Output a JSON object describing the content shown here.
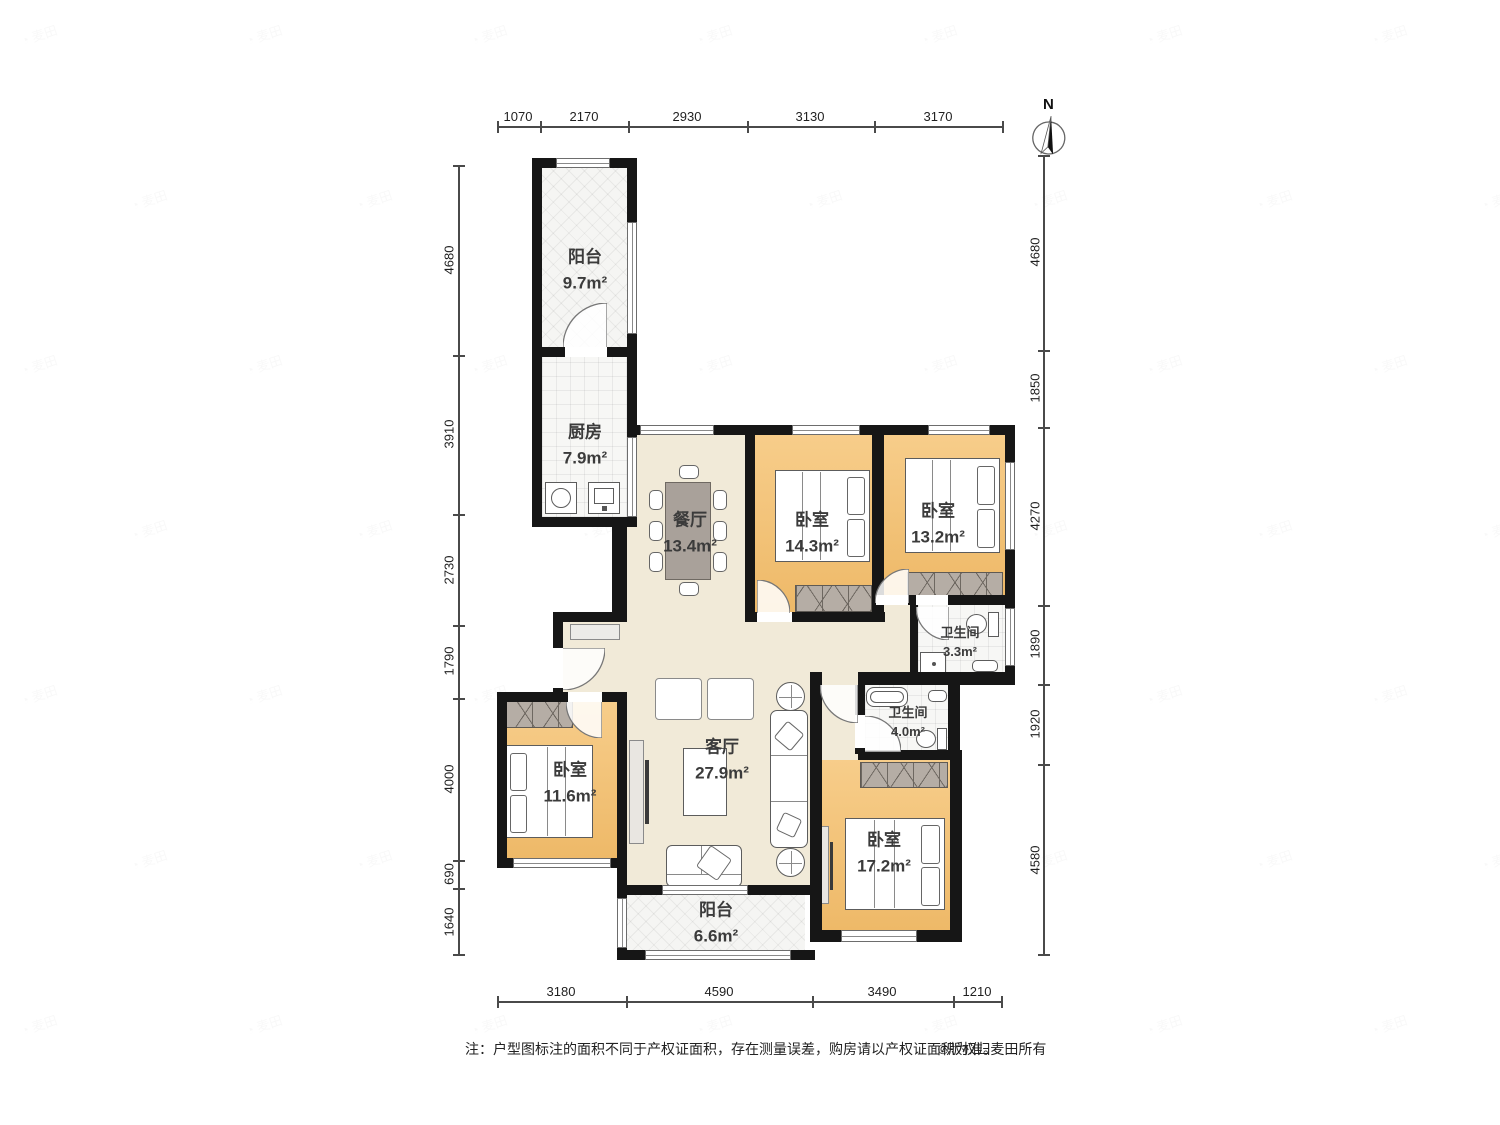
{
  "compass": {
    "north_label": "N"
  },
  "note": {
    "text": "注：户型图标注的面积不同于产权证面积，存在测量误差，购房请以产权证面积为准。",
    "copyright": "©版权归麦田所有"
  },
  "watermark": {
    "text": "麦田"
  },
  "dimensions": {
    "top": [
      "1070",
      "2170",
      "2930",
      "3130",
      "3170"
    ],
    "bottom": [
      "3180",
      "4590",
      "3490",
      "1210"
    ],
    "left": [
      "4680",
      "3910",
      "2730",
      "1790",
      "4000",
      "690",
      "1640"
    ],
    "right": [
      "4680",
      "1850",
      "4270",
      "1890",
      "1920",
      "4580"
    ]
  },
  "rooms": {
    "balcony_top": {
      "name": "阳台",
      "area": "9.7m²"
    },
    "kitchen": {
      "name": "厨房",
      "area": "7.9m²"
    },
    "dining": {
      "name": "餐厅",
      "area": "13.4m²"
    },
    "bedroom_ne": {
      "name": "卧室",
      "area": "14.3m²"
    },
    "bedroom_e": {
      "name": "卧室",
      "area": "13.2m²"
    },
    "bath_small": {
      "name": "卫生间",
      "area": "3.3m²"
    },
    "bath_large": {
      "name": "卫生间",
      "area": "4.0m²"
    },
    "living": {
      "name": "客厅",
      "area": "27.9m²"
    },
    "bedroom_w": {
      "name": "卧室",
      "area": "11.6m²"
    },
    "bedroom_s": {
      "name": "卧室",
      "area": "17.2m²"
    },
    "balcony_bottom": {
      "name": "阳台",
      "area": "6.6m²"
    }
  },
  "colors": {
    "wall": "#161616",
    "wood_floor": "#f2c172",
    "cream_floor": "#f1ead8",
    "tile_floor": "#f6f6f4",
    "wardrobe": "#b5ada5",
    "dimension_text": "#1f1f1f"
  }
}
